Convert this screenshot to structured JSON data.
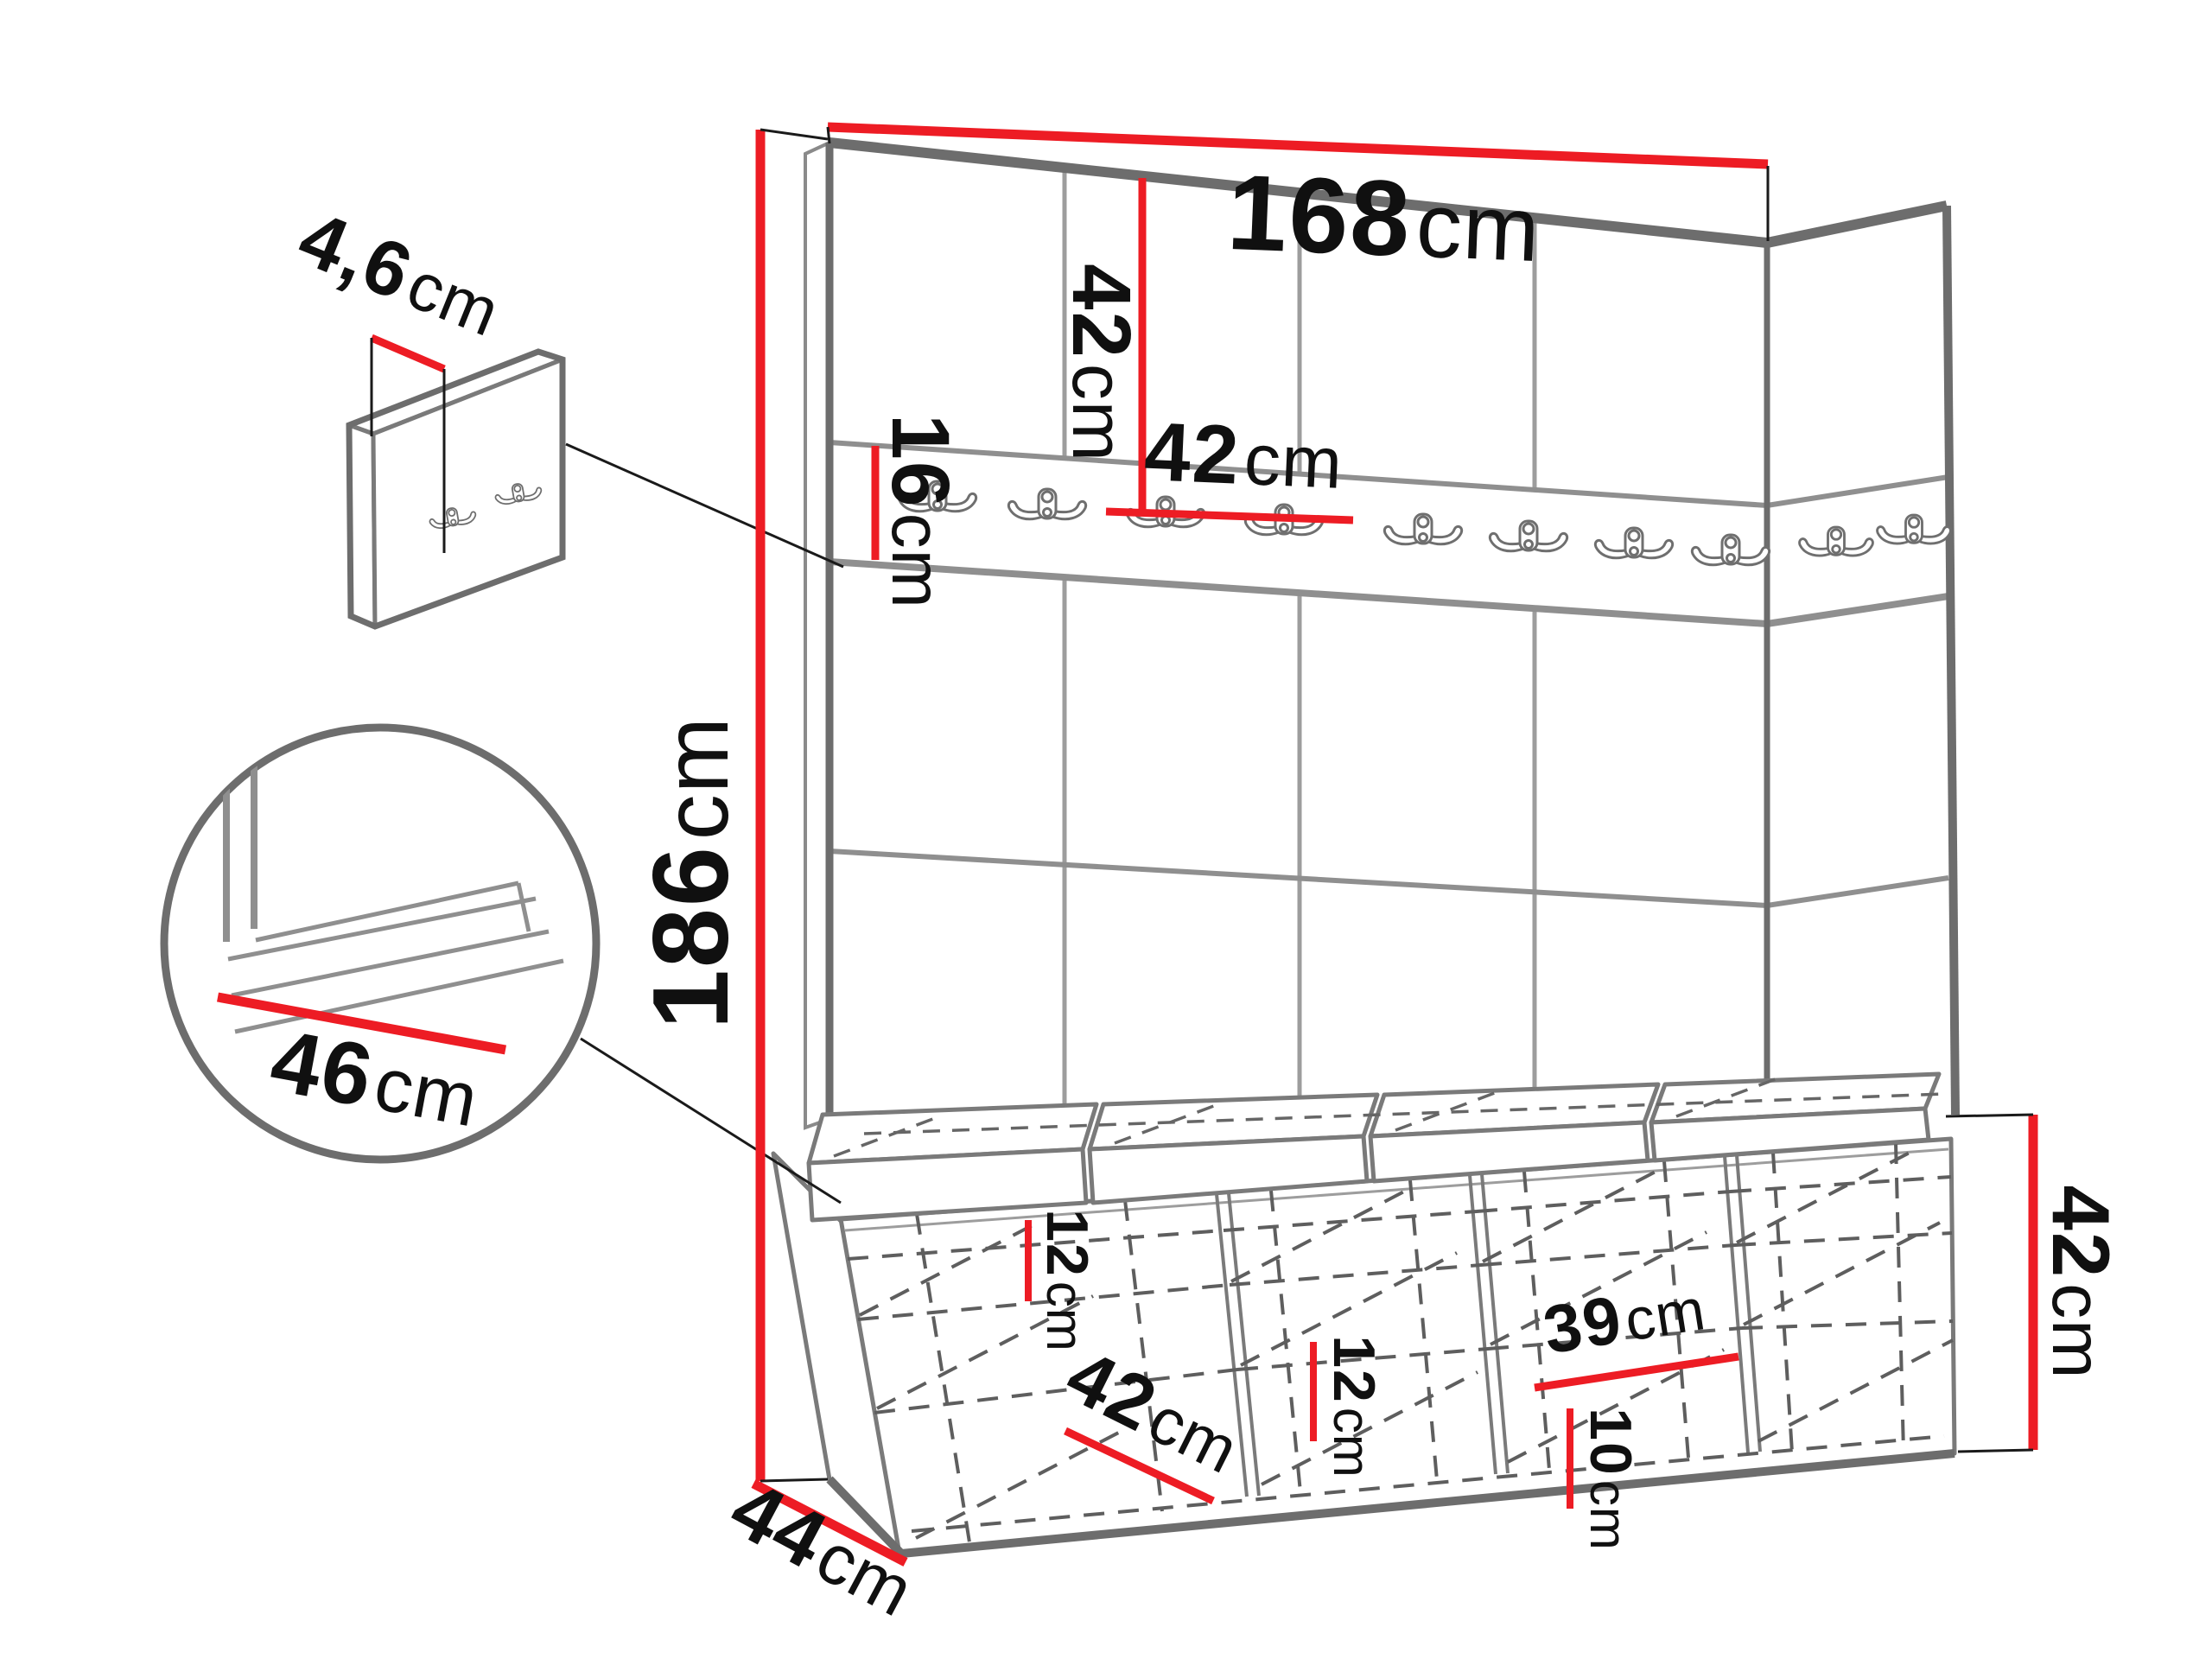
{
  "diagram": {
    "type": "furniture-dimension-diagram",
    "subject": "hallway wardrobe set with upholstered wall panels, hook rail, corner return and shoe-storage bench",
    "dimensions": {
      "total_width": {
        "value": "168",
        "unit": "cm"
      },
      "total_height": {
        "value": "186",
        "unit": "cm"
      },
      "panel_height": {
        "value": "42",
        "unit": "cm"
      },
      "panel_width": {
        "value": "42",
        "unit": "cm"
      },
      "hook_rail_height": {
        "value": "16",
        "unit": "cm"
      },
      "hook_panel_thickness": {
        "value": "4,6",
        "unit": "cm"
      },
      "seat_depth": {
        "value": "46",
        "unit": "cm"
      },
      "left_shelf_gap": {
        "value": "12",
        "unit": "cm"
      },
      "middle_shelf_gap": {
        "value": "12",
        "unit": "cm"
      },
      "left_compartment_width": {
        "value": "42",
        "unit": "cm"
      },
      "right_compartment_width": {
        "value": "39",
        "unit": "cm"
      },
      "right_bottom_gap": {
        "value": "10",
        "unit": "cm"
      },
      "bench_height": {
        "value": "42",
        "unit": "cm"
      },
      "bench_depth": {
        "value": "44",
        "unit": "cm"
      }
    },
    "counts": {
      "rail_hooks": 10,
      "detail_panel_hooks": 2,
      "wall_panel_columns": 4,
      "seat_cushions": 4,
      "bench_compartments": 4,
      "shelves_per_compartment": 2
    },
    "colors": {
      "dimension_red": "#ed1c24",
      "outline_gray": "#6d6d6d",
      "seam_gray": "#9d9d9d",
      "dash_gray": "#5e5e5e",
      "text_black": "#101010",
      "background": "#ffffff"
    }
  }
}
